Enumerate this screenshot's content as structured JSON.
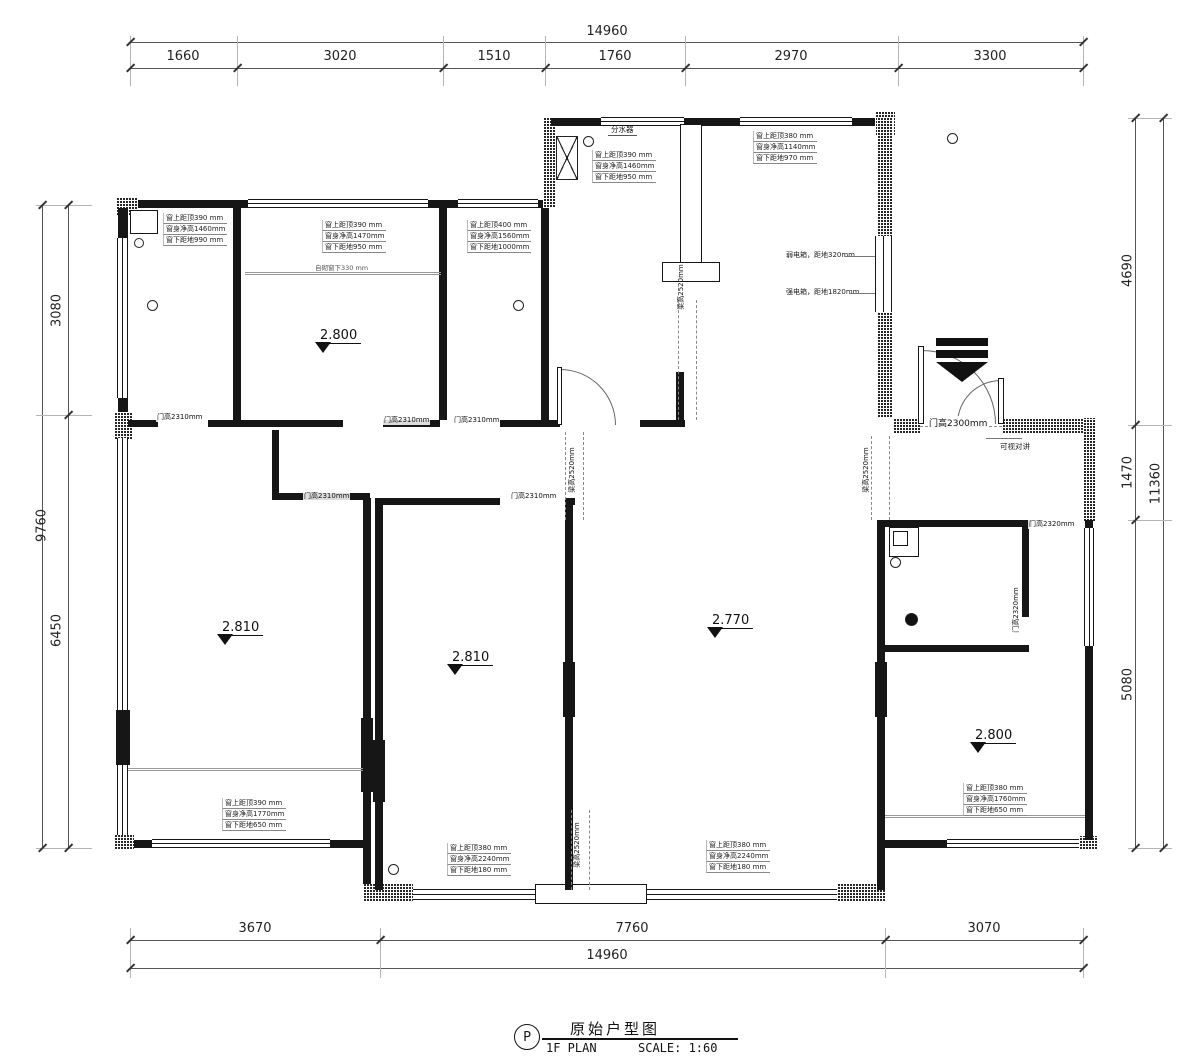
{
  "doc": {
    "badge": "P",
    "title_cn": "原始户型图",
    "plan_label": "1F PLAN",
    "scale_label": "SCALE: 1:60"
  },
  "dims": {
    "top_total": "14960",
    "top": [
      "1660",
      "3020",
      "1510",
      "1760",
      "2970",
      "3300"
    ],
    "bottom": [
      "3670",
      "7760",
      "3070"
    ],
    "bottom_total": "14960",
    "left_total": "9760",
    "left": [
      "3080",
      "6450"
    ],
    "right": [
      "4690",
      "1470",
      "5080"
    ],
    "right_total": "11360"
  },
  "levels": {
    "l1": "2.800",
    "l2": "2.810",
    "l3": "2.810",
    "l4": "2.770",
    "l5": "2.800"
  },
  "windows": {
    "w1": {
      "l1": "窗上距顶390 mm",
      "l2": "窗身净高1460mm",
      "l3": "窗下距地990 mm"
    },
    "w2": {
      "l1": "窗上距顶390 mm",
      "l2": "窗身净高1470mm",
      "l3": "窗下距地950 mm"
    },
    "w3": {
      "l1": "窗上距顶400 mm",
      "l2": "窗身净高1560mm",
      "l3": "窗下距地1000mm"
    },
    "w4": {
      "l1": "窗上距顶390 mm",
      "l2": "窗身净高1460mm",
      "l3": "窗下距地950 mm"
    },
    "w5": {
      "l1": "窗上距顶380 mm",
      "l2": "窗身净高1140mm",
      "l3": "窗下距地970 mm"
    },
    "w6": {
      "l1": "窗上距顶390 mm",
      "l2": "窗身净高1770mm",
      "l3": "窗下距地650 mm"
    },
    "w7": {
      "l1": "窗上距顶380 mm",
      "l2": "窗身净高2240mm",
      "l3": "窗下距地180 mm"
    },
    "w8": {
      "l1": "窗上距顶380 mm",
      "l2": "窗身净高2240mm",
      "l3": "窗下距地180 mm"
    },
    "w9": {
      "l1": "窗上距顶380 mm",
      "l2": "窗身净高1760mm",
      "l3": "窗下距地650 mm"
    }
  },
  "sill_note": "自砌窗下330 mm",
  "doors": {
    "d1": "门高2310mm",
    "d2": "门高2310mm",
    "d3": "门高2310mm",
    "d4": "门高2310mm",
    "d5": "门高2310mm",
    "entry": "门高2300mm",
    "bath_a": "门高2320mm",
    "bath_b": "门高2320mm"
  },
  "beams": {
    "b1": "梁高2520mm",
    "b2": "梁高2520mm",
    "b3": "梁高2520mm",
    "b4": "梁高2520mm"
  },
  "electrical": {
    "weak": "弱电箱，距地320mm",
    "strong": "强电箱，距地1820mm"
  },
  "labels": {
    "manifold": "分水器",
    "intercom": "可视对讲"
  }
}
